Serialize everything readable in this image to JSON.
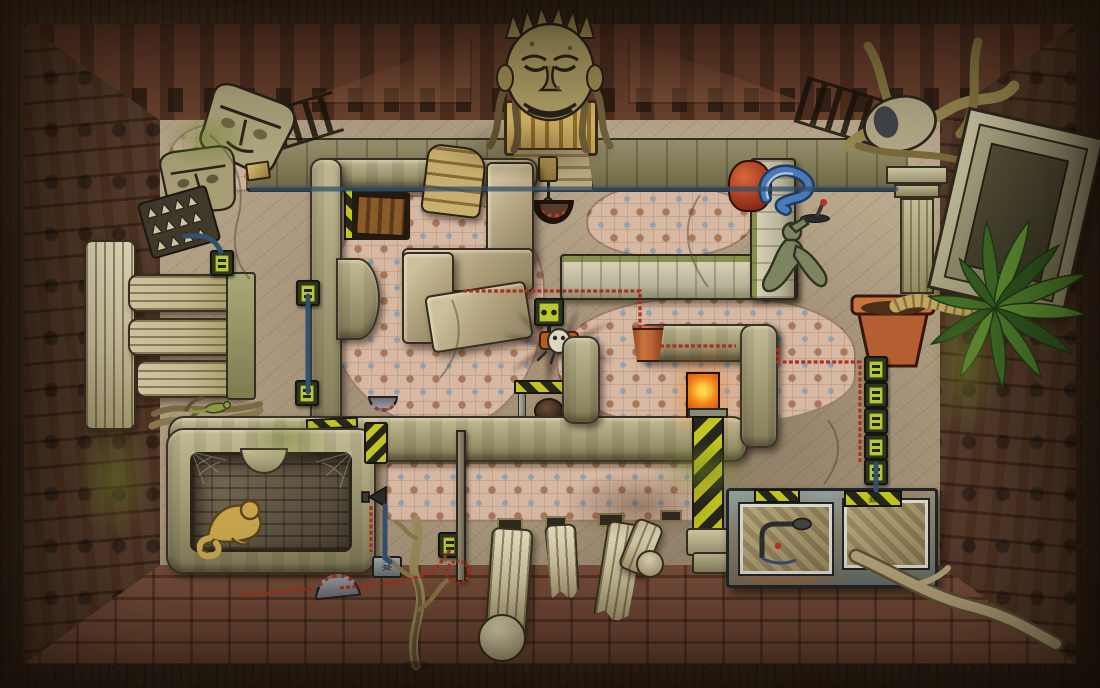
{
  "meta": {
    "app": "point-and-click-adventure",
    "title": "Ruined temple chamber — top-down puzzle room",
    "width": 1100,
    "height": 688
  },
  "palette": {
    "frame": "#2f231a",
    "wall-top": "#7c5038",
    "wall-side": "#6e4a36",
    "wall-bottom": "#8c5f49",
    "floor": "#b3a084",
    "mosaic": "#d6b8a3",
    "mosaic-accent": "#8fa0ae",
    "stone": "#a09872",
    "stone-light": "#ccc4a0",
    "stone-dark": "#3a3226",
    "brick-light": "#cdc6ab",
    "hazard": "#c2c41f",
    "hazard-dark": "#26261a",
    "switch-green": "#b9c832",
    "cable-red": "#a8311f",
    "pipe-blue": "#33506e",
    "terracotta": "#b65f33",
    "lava": "#e06818",
    "palm-green": "#4c7c2c",
    "gold": "#c9a54e",
    "bronze": "#7c8560",
    "bone": "#d8cfae"
  },
  "icons": {
    "skull": "☠"
  },
  "counts": {
    "green_switches_total": 9,
    "switch_column_size": 5,
    "fallen_columns": 4,
    "moai_heads": 2,
    "skull_plates": 2
  },
  "objects": {
    "room": {
      "label": "Overgrown temple chamber viewed from above"
    },
    "face_idol": {
      "label": "Carved stone face idol with crown"
    },
    "gate": {
      "label": "Golden slatted gate beneath the idol"
    },
    "gate_steps": {
      "label": "Stair landing below the gate"
    },
    "lamp": {
      "label": "Hanging lantern on a pole"
    },
    "gear_arch": {
      "label": "Arched recess with red-toothed gear"
    },
    "moai_heads": {
      "label": "Two toppled stone heads"
    },
    "spike_trap": {
      "label": "Spike panel on the left wall"
    },
    "ladder_wood": {
      "label": "Wooden ladder in a recess"
    },
    "ladder_brick": {
      "label": "Brick stair ramp draped over the wall"
    },
    "stone_slabs": {
      "label": "Large fallen stone slabs"
    },
    "arc_wall": {
      "label": "Curved walkway wall with arc bulge"
    },
    "walkway_beam": {
      "label": "Long stone walkway across the room"
    },
    "white_wall": {
      "label": "Light brick parapet wall"
    },
    "red_pot": {
      "label": "Red vessel on the parapet corner"
    },
    "blue_snake": {
      "label": "Blue snake coiled by the parapet"
    },
    "small_lever": {
      "label": "Small floor lever"
    },
    "fallen_statue": {
      "label": "Fallen bronze statue"
    },
    "overgrown_head": {
      "label": "Stone head strangled by roots"
    },
    "stele": {
      "label": "Leaning carved stele frame"
    },
    "pillar_ruin": {
      "label": "Ruined pillar by the right wall"
    },
    "railing": {
      "label": "Dark slatted railing on the ledge"
    },
    "palm": {
      "label": "Palm growing from a terracotta pot"
    },
    "switch_left": {
      "label": "Green wall switch (west ledge)"
    },
    "switch_arc_upper": {
      "label": "Green switch beside the arc wall (upper)"
    },
    "switch_arc_lower": {
      "label": "Green switch beside the arc wall (lower)"
    },
    "footprint_panel": {
      "label": "Footprint sensor panel"
    },
    "spider_robot": {
      "label": "Spider robot casting a long shadow"
    },
    "hazard_table": {
      "label": "Hazard-striped pedestal table"
    },
    "floor_hole": {
      "label": "Round opening under the table"
    },
    "wall_pot": {
      "label": "Terracotta pot mounted on wall end"
    },
    "lava_pit": {
      "label": "Glowing furnace pit"
    },
    "hazard_pillar": {
      "label": "Hazard-striped pillar"
    },
    "switch_column": {
      "label": "Column of five green switches"
    },
    "wall_switch_bottom": {
      "label": "Green switch on the south wall"
    },
    "cabinet": {
      "label": "Rusty display cabinet"
    },
    "cabinet_window_left": {
      "label": "Cabinet window with lever device"
    },
    "cabinet_window_right": {
      "label": "Cabinet window pierced by a root"
    },
    "cabinet_lever": {
      "label": "Lever device inside cabinet"
    },
    "cabinet_root": {
      "label": "Root growing through the cabinet"
    },
    "vent_grate": {
      "label": "Striped vent grate on cabinet top"
    },
    "skull_grate": {
      "label": "Striped grate with skull mark"
    },
    "skull_plate": {
      "label": "Skull warning plate"
    },
    "speaker_horn": {
      "label": "Wall-mounted horn speaker"
    },
    "hazard_sign": {
      "label": "Hazard-striped wall sign"
    },
    "gear_wheel": {
      "label": "Half-buried toothed wheel"
    },
    "pit": {
      "label": "Sunken pit chamber"
    },
    "pit_figure": {
      "label": "Golden crouching figure in the pit"
    },
    "cobwebs": {
      "label": "Cobwebs in the pit corners"
    },
    "columns_trio": {
      "label": "Three standing fluted columns"
    },
    "architrave": {
      "label": "Stone architrave over the columns"
    },
    "root_branch": {
      "label": "Dry root below the columns"
    },
    "fallen_columns": {
      "label": "Fallen fluted columns"
    },
    "column_sockets": {
      "label": "Empty column sockets in the wall"
    },
    "dead_tree": {
      "label": "Withered sapling"
    },
    "lizard_branch": {
      "label": "Dry branch with a lizard"
    },
    "stone_block_small": {
      "label": "Small stone block"
    },
    "red_cable": {
      "label": "Red cable running through the room"
    },
    "blue_pipe": {
      "label": "Blue pipe line"
    },
    "mosaic_floor": {
      "label": "Patterned mosaic floor patch"
    },
    "top_ledge": {
      "label": "Raised ledge along the north wall"
    }
  }
}
